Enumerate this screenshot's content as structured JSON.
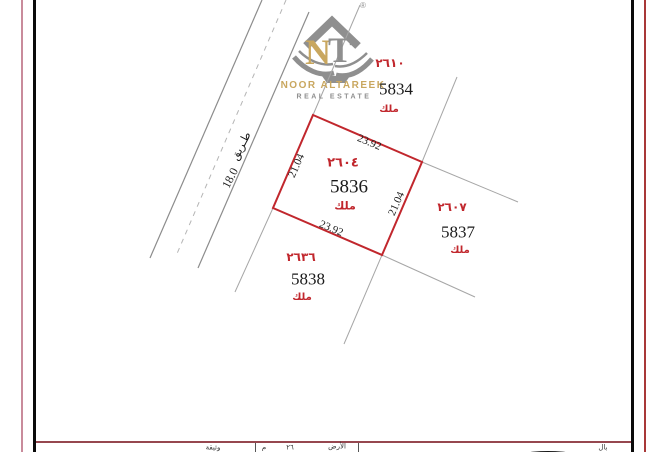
{
  "colors": {
    "plot_outline_red": "#c1272d",
    "parcel_text_red": "#c1272d",
    "boundary_gray": "#a6a6a6",
    "road_gray": "#8c8c8c",
    "frame_black": "#0a0a0a",
    "frame_rose_left": "#c98b9b",
    "frame_red_right": "#a83838",
    "footer_rule_maroon": "#96474f",
    "logo_gold": "#c9a75f",
    "logo_gray": "#8f8f8f"
  },
  "logo": {
    "letter_n": "N",
    "letter_t": "T",
    "name": "NOOR ALTAREEK",
    "tagline": "REAL ESTATE",
    "registered_mark": "®"
  },
  "road": {
    "name": "طـريق",
    "width_value": "18.0"
  },
  "plots": {
    "p5834": {
      "parcel_no_arabic": "٢٦١٠",
      "plot_no": "5834",
      "tenure": "ملك"
    },
    "p5836": {
      "parcel_no_arabic": "٢٦٠٤",
      "plot_no": "5836",
      "tenure": "ملك",
      "dim_top_m": "23.92",
      "dim_bottom_m": "23.92",
      "dim_left_m": "21.04",
      "dim_right_m": "21.04"
    },
    "p5837": {
      "parcel_no_arabic": "٢٦٠٧",
      "plot_no": "5837",
      "tenure": "ملك"
    },
    "p5838": {
      "parcel_no_arabic": "٢٦٣٦",
      "plot_no": "5838",
      "tenure": "ملك"
    }
  },
  "footer": {
    "fragments": {
      "doc": "وثيقة",
      "f1": "م",
      "f2": "٢٦",
      "f3": "الأرض",
      "f4": "بال"
    }
  }
}
